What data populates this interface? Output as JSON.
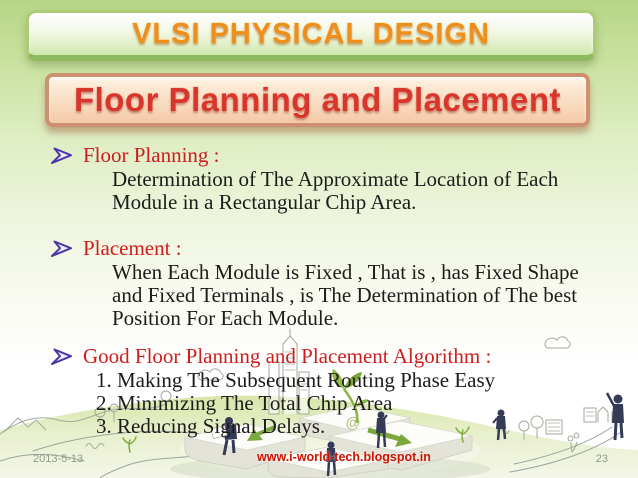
{
  "slide": {
    "title": "VLSI PHYSICAL DESIGN",
    "subtitle": "Floor Planning and Placement"
  },
  "content": {
    "sections": [
      {
        "heading": "Floor Planning :",
        "lines": [
          "Determination of The Approximate Location of Each",
          "Module in a Rectangular Chip Area."
        ]
      },
      {
        "heading": "Placement :",
        "lines": [
          "When Each Module is Fixed , That is , has Fixed Shape",
          "and Fixed Terminals , is The Determination of The best",
          "Position For Each Module."
        ]
      },
      {
        "heading": "Good Floor Planning and Placement Algorithm :",
        "lines": [
          "1. Making The Subsequent Routing Phase Easy",
          "2. Minimizing The Total Chip Area",
          "3. Reducing Signal Delays."
        ]
      }
    ]
  },
  "footer": {
    "date": "2013-5-13",
    "url": "www.i-world-tech.blogspot.in",
    "page": "23"
  },
  "icons": {
    "bullet": "arrow-right-bullet-icon"
  },
  "colors": {
    "title-orange": "#ee8f1d",
    "subtitle-red": "#d8352c",
    "heading-red": "#cf1d1d",
    "url-red": "#cc1403",
    "footer-grey": "#8f9b8d",
    "bullet-purple": "#4b36a8",
    "banner-green-border": "#abcb74",
    "banner-peach-border": "#cd9070",
    "background-green": "#b5d687"
  }
}
